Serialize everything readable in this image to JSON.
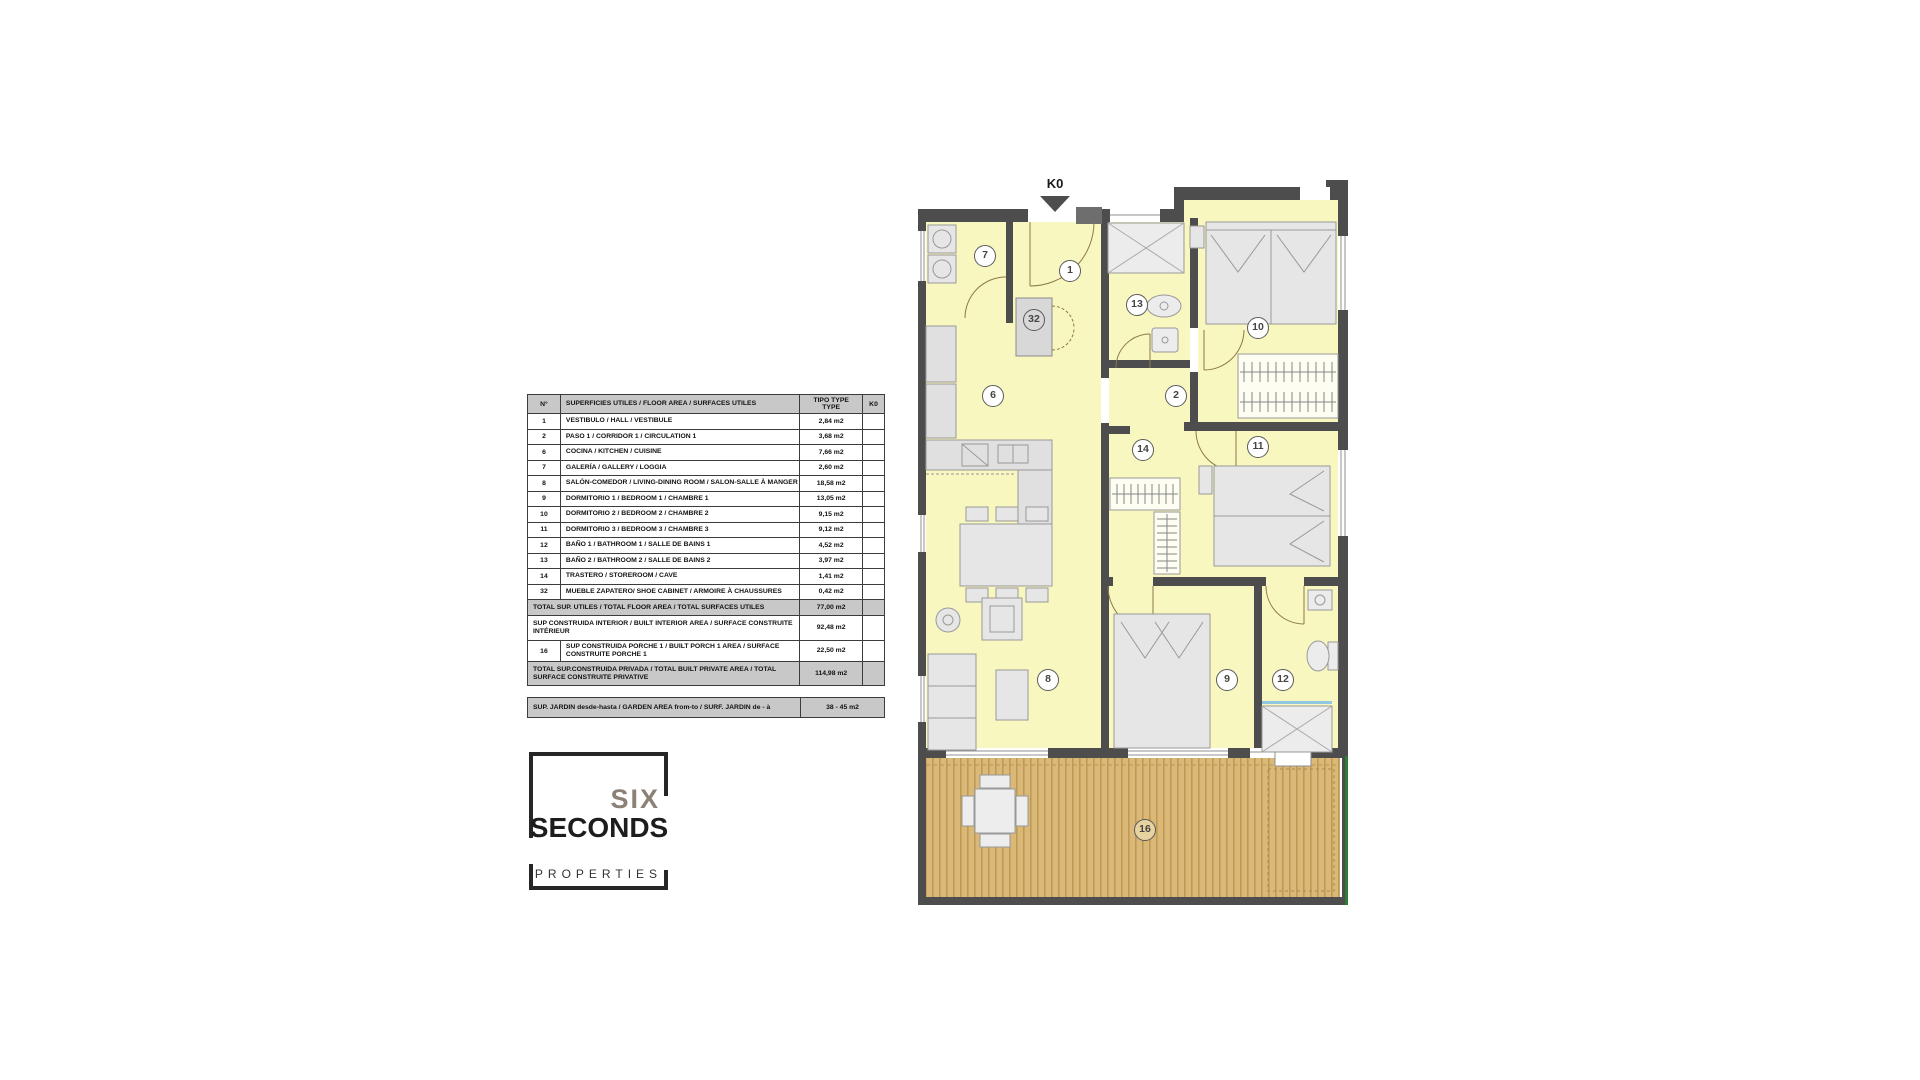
{
  "table": {
    "header": {
      "col_num": "N°",
      "col_desc": "SUPERFICIES UTILES / FLOOR AREA / SURFACES UTILES",
      "col_type_line1": "TIPO TYPE",
      "col_type_line2": "TYPE",
      "col_k0": "K0"
    },
    "rows": [
      {
        "num": "1",
        "label": "VESTIBULO / HALL  /  VESTIBULE",
        "value": "2,84 m2"
      },
      {
        "num": "2",
        "label": "PASO 1  / CORRIDOR 1  / CIRCULATION 1",
        "value": "3,68 m2"
      },
      {
        "num": "6",
        "label": "COCINA / KITCHEN / CUISINE",
        "value": "7,66 m2"
      },
      {
        "num": "7",
        "label": "GALERÍA / GALLERY / LOGGIA",
        "value": "2,60 m2"
      },
      {
        "num": "8",
        "label": "SALÓN-COMEDOR / LIVING-DINING ROOM / SALON-SALLE À MANGER",
        "value": "18,58 m2"
      },
      {
        "num": "9",
        "label": "DORMITORIO 1 / BEDROOM 1 / CHAMBRE 1",
        "value": "13,05 m2"
      },
      {
        "num": "10",
        "label": "DORMITORIO 2 / BEDROOM 2 / CHAMBRE 2",
        "value": "9,15 m2"
      },
      {
        "num": "11",
        "label": "DORMITORIO 3 / BEDROOM 3 / CHAMBRE 3",
        "value": "9,12 m2"
      },
      {
        "num": "12",
        "label": "BAÑO 1 / BATHROOM 1 / SALLE DE BAINS 1",
        "value": "4,52 m2"
      },
      {
        "num": "13",
        "label": "BAÑO 2 / BATHROOM 2 / SALLE DE BAINS 2",
        "value": "3,97 m2"
      },
      {
        "num": "14",
        "label": "TRASTERO / STOREROOM / CAVE",
        "value": "1,41 m2"
      },
      {
        "num": "32",
        "label": "MUEBLE ZAPATERO/ SHOE CABINET / ARMOIRE À CHAUSSURES",
        "value": "0,42 m2"
      }
    ],
    "total_utiles": {
      "label": "TOTAL SUP. UTILES / TOTAL FLOOR AREA / TOTAL SURFACES UTILES",
      "value": "77,00 m2"
    },
    "built_interior": {
      "label": "SUP CONSTRUIDA INTERIOR / BUILT INTERIOR AREA / SURFACE CONSTRUITE INTÉRIEUR",
      "value": "92,48 m2"
    },
    "porch": {
      "num": "16",
      "label": "SUP CONSTRUIDA PORCHE 1 / BUILT PORCH 1 AREA / SURFACE CONSTRUITE PORCHE 1",
      "value": "22,50 m2"
    },
    "total_private": {
      "label": "TOTAL SUP.CONSTRUIDA PRIVADA / TOTAL  BUILT PRIVATE AREA / TOTAL SURFACE CONSTRUITE PRIVATIVE",
      "value": "114,98 m2"
    },
    "garden": {
      "label": "SUP. JARDIN desde-hasta / GARDEN AREA from-to / SURF. JARDIN  de - à",
      "value": "38 - 45 m2"
    }
  },
  "logo": {
    "line1": "SIX",
    "line2": "SECONDS",
    "line3": "PROPERTIES"
  },
  "plan": {
    "north_label": "K0",
    "room_labels": [
      {
        "num": "7"
      },
      {
        "num": "1"
      },
      {
        "num": "13"
      },
      {
        "num": "10"
      },
      {
        "num": "32"
      },
      {
        "num": "6"
      },
      {
        "num": "2"
      },
      {
        "num": "14"
      },
      {
        "num": "11"
      },
      {
        "num": "8"
      },
      {
        "num": "9"
      },
      {
        "num": "12"
      },
      {
        "num": "16"
      }
    ]
  },
  "colors": {
    "wall": "#4d4d4d",
    "floor": "#f9f7c0",
    "deck": "#d9b878",
    "deck_stripe": "#c09a55",
    "garden_line": "#2e7d32",
    "furniture_fill": "#e6e6e6",
    "furniture_stroke": "#999999",
    "table_header_bg": "#c8c8c8",
    "logo_grey": "#8c8176",
    "logo_black": "#1d1d1d"
  }
}
